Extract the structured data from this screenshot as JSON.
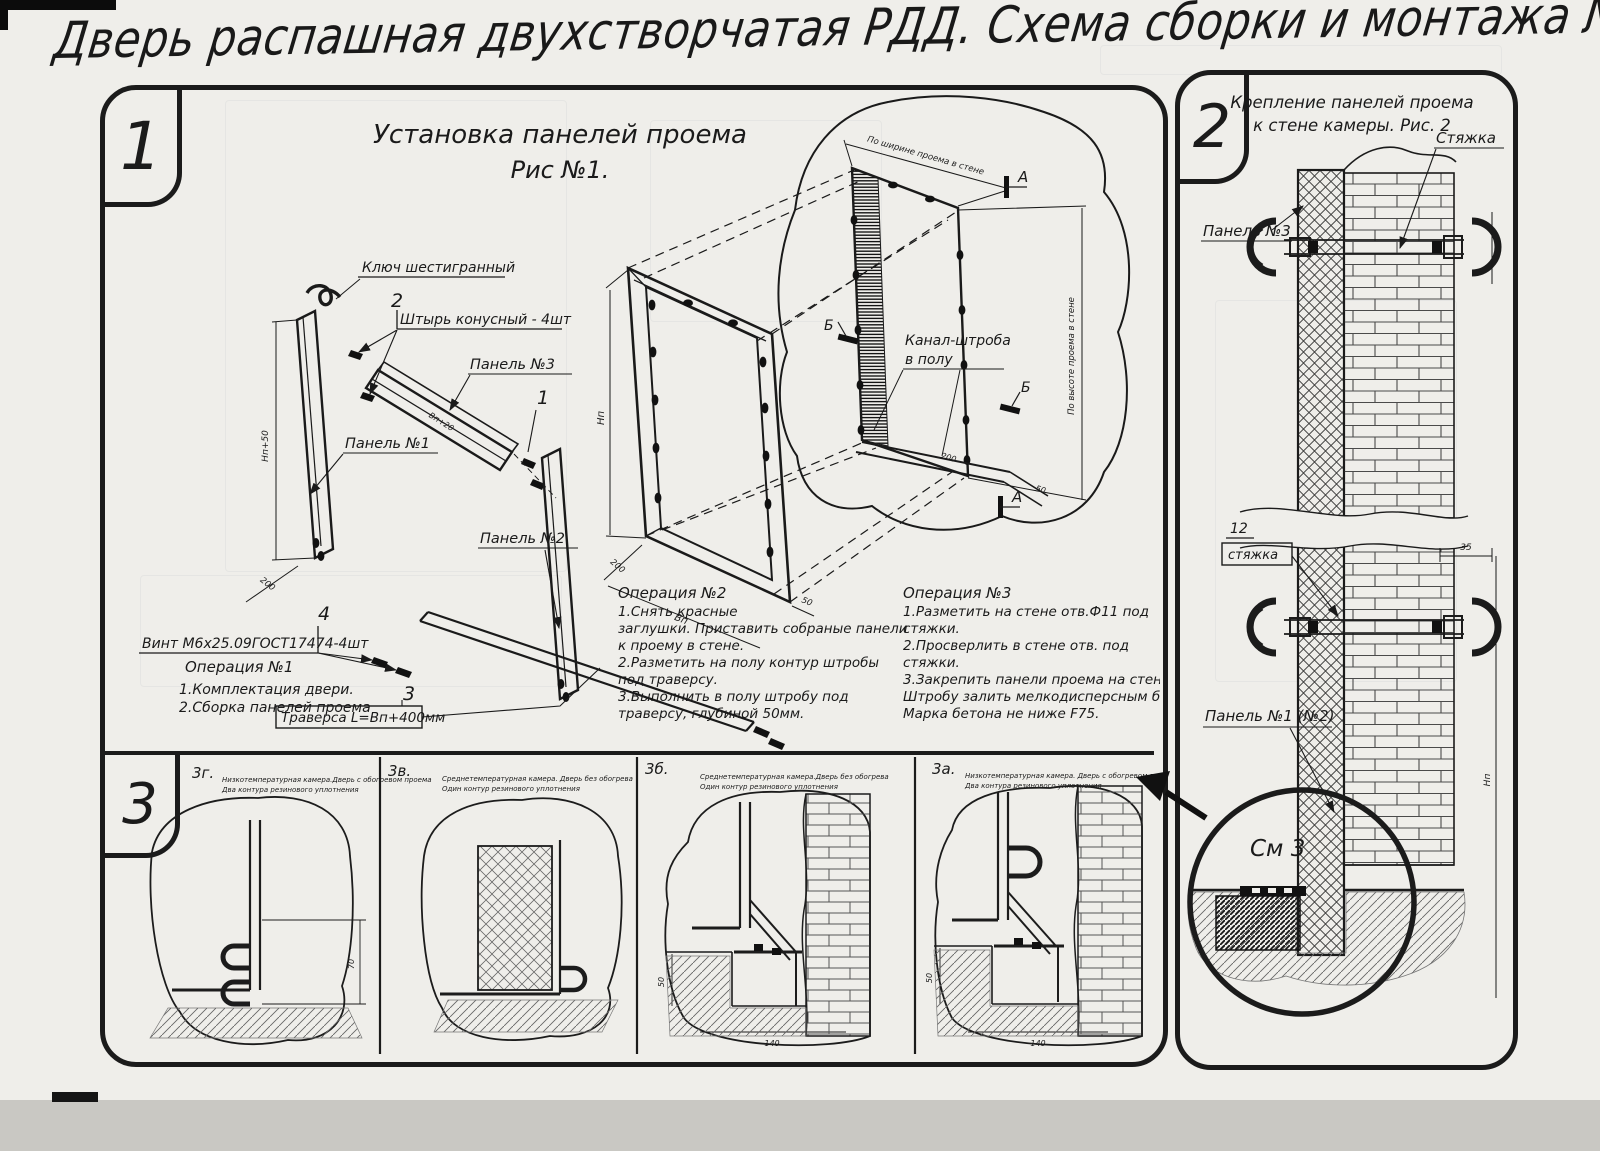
{
  "page": {
    "title": "Дверь распашная двухстворчатая РДД.  Схема сборки и монтажа №2"
  },
  "fig1": {
    "tab": "1",
    "title1": "Установка панелей проема",
    "title2": "Рис №1.",
    "hex_key_label": "Ключ шестигранный",
    "pin_num": "2",
    "pin_label": "Штырь конусный - 4шт",
    "panel3_label": "Панель №3",
    "panel1_label": "Панель №1",
    "panel2_label": "Панель №2",
    "num1": "1",
    "num4": "4",
    "screw_label": "Винт М6х25.09ГОСТ17474-4шт",
    "num3": "3",
    "traverse_label": "Траверса  L=Bп+400мм",
    "channel_label1": "Канал-штроба",
    "channel_label2": "в полу",
    "dim_opening_width": "По ширине проема в стене",
    "dim_opening_height": "По высоте проема в стене",
    "marker_a": "А",
    "marker_b": "Б",
    "dims": {
      "p1h": "Нп+50",
      "p1w": "200",
      "bar": "Вп+20",
      "fh": "Нп",
      "fw": "Вп",
      "f200": "200",
      "f50": "50",
      "ch200": "200",
      "ch50": "50"
    },
    "op1_title": "Операция №1",
    "op1_l1": "1.Комплектация двери.",
    "op1_l2": "2.Сборка панелей проема",
    "op2_title": "Операция №2",
    "op2_l1": "1.Снять красные",
    "op2_l2": "заглушки. Приставить собраные панели",
    "op2_l3": "к проему в стене.",
    "op2_l4": "2.Разметить на полу контур штробы",
    "op2_l5": "под траверсу.",
    "op2_l6": "3.Выполнить в полу штробу под",
    "op2_l7": "траверсу, глубиной 50мм.",
    "op3_title": "Операция №3",
    "op3_l1": "1.Разметить на стене отв.Ф11 под",
    "op3_l2": "стяжки.",
    "op3_l3": "2.Просверлить в стене отв.   под",
    "op3_l4": "стяжки.",
    "op3_l5": "3.Закрепить панели проема на стене камеры.",
    "op3_l6": "Штробу залить мелкодисперсным бетоном",
    "op3_l7": "Марка бетона не ниже   F75."
  },
  "fig2": {
    "tab": "2",
    "title1": "Крепление панелей проема",
    "title2": "к стене камеры. Рис. 2",
    "tie_label": "Стяжка",
    "panel3_label": "Панель №3",
    "pos12": "12",
    "tie_small_label": "стяжка",
    "panel12_label": "Панель №1 (№2)",
    "see3": "См 3",
    "dim35": "35",
    "dim_right": "Нп"
  },
  "fig3": {
    "tab": "3",
    "cells": [
      {
        "id": "3г.",
        "cap1": "Низкотемпературная камера.Дверь с обогревом проема",
        "cap2": "Два контура резинового уплотнения",
        "dim": "70"
      },
      {
        "id": "3в.",
        "cap1": "Среднетемпературная камера. Дверь без обогрева",
        "cap2": "Один контур резинового уплотнения"
      },
      {
        "id": "3б.",
        "cap1": "Среднетемпературная камера.Дверь без обогрева",
        "cap2": "Один контур резинового уплотнения",
        "dim_v": "50",
        "dim_h": "140"
      },
      {
        "id": "3а.",
        "cap1": "Низкотемпературная камера. Дверь с обогревом проема и порога",
        "cap2": "Два контура резинового уплотнения",
        "dim_v": "50",
        "dim_h": "140"
      }
    ]
  }
}
